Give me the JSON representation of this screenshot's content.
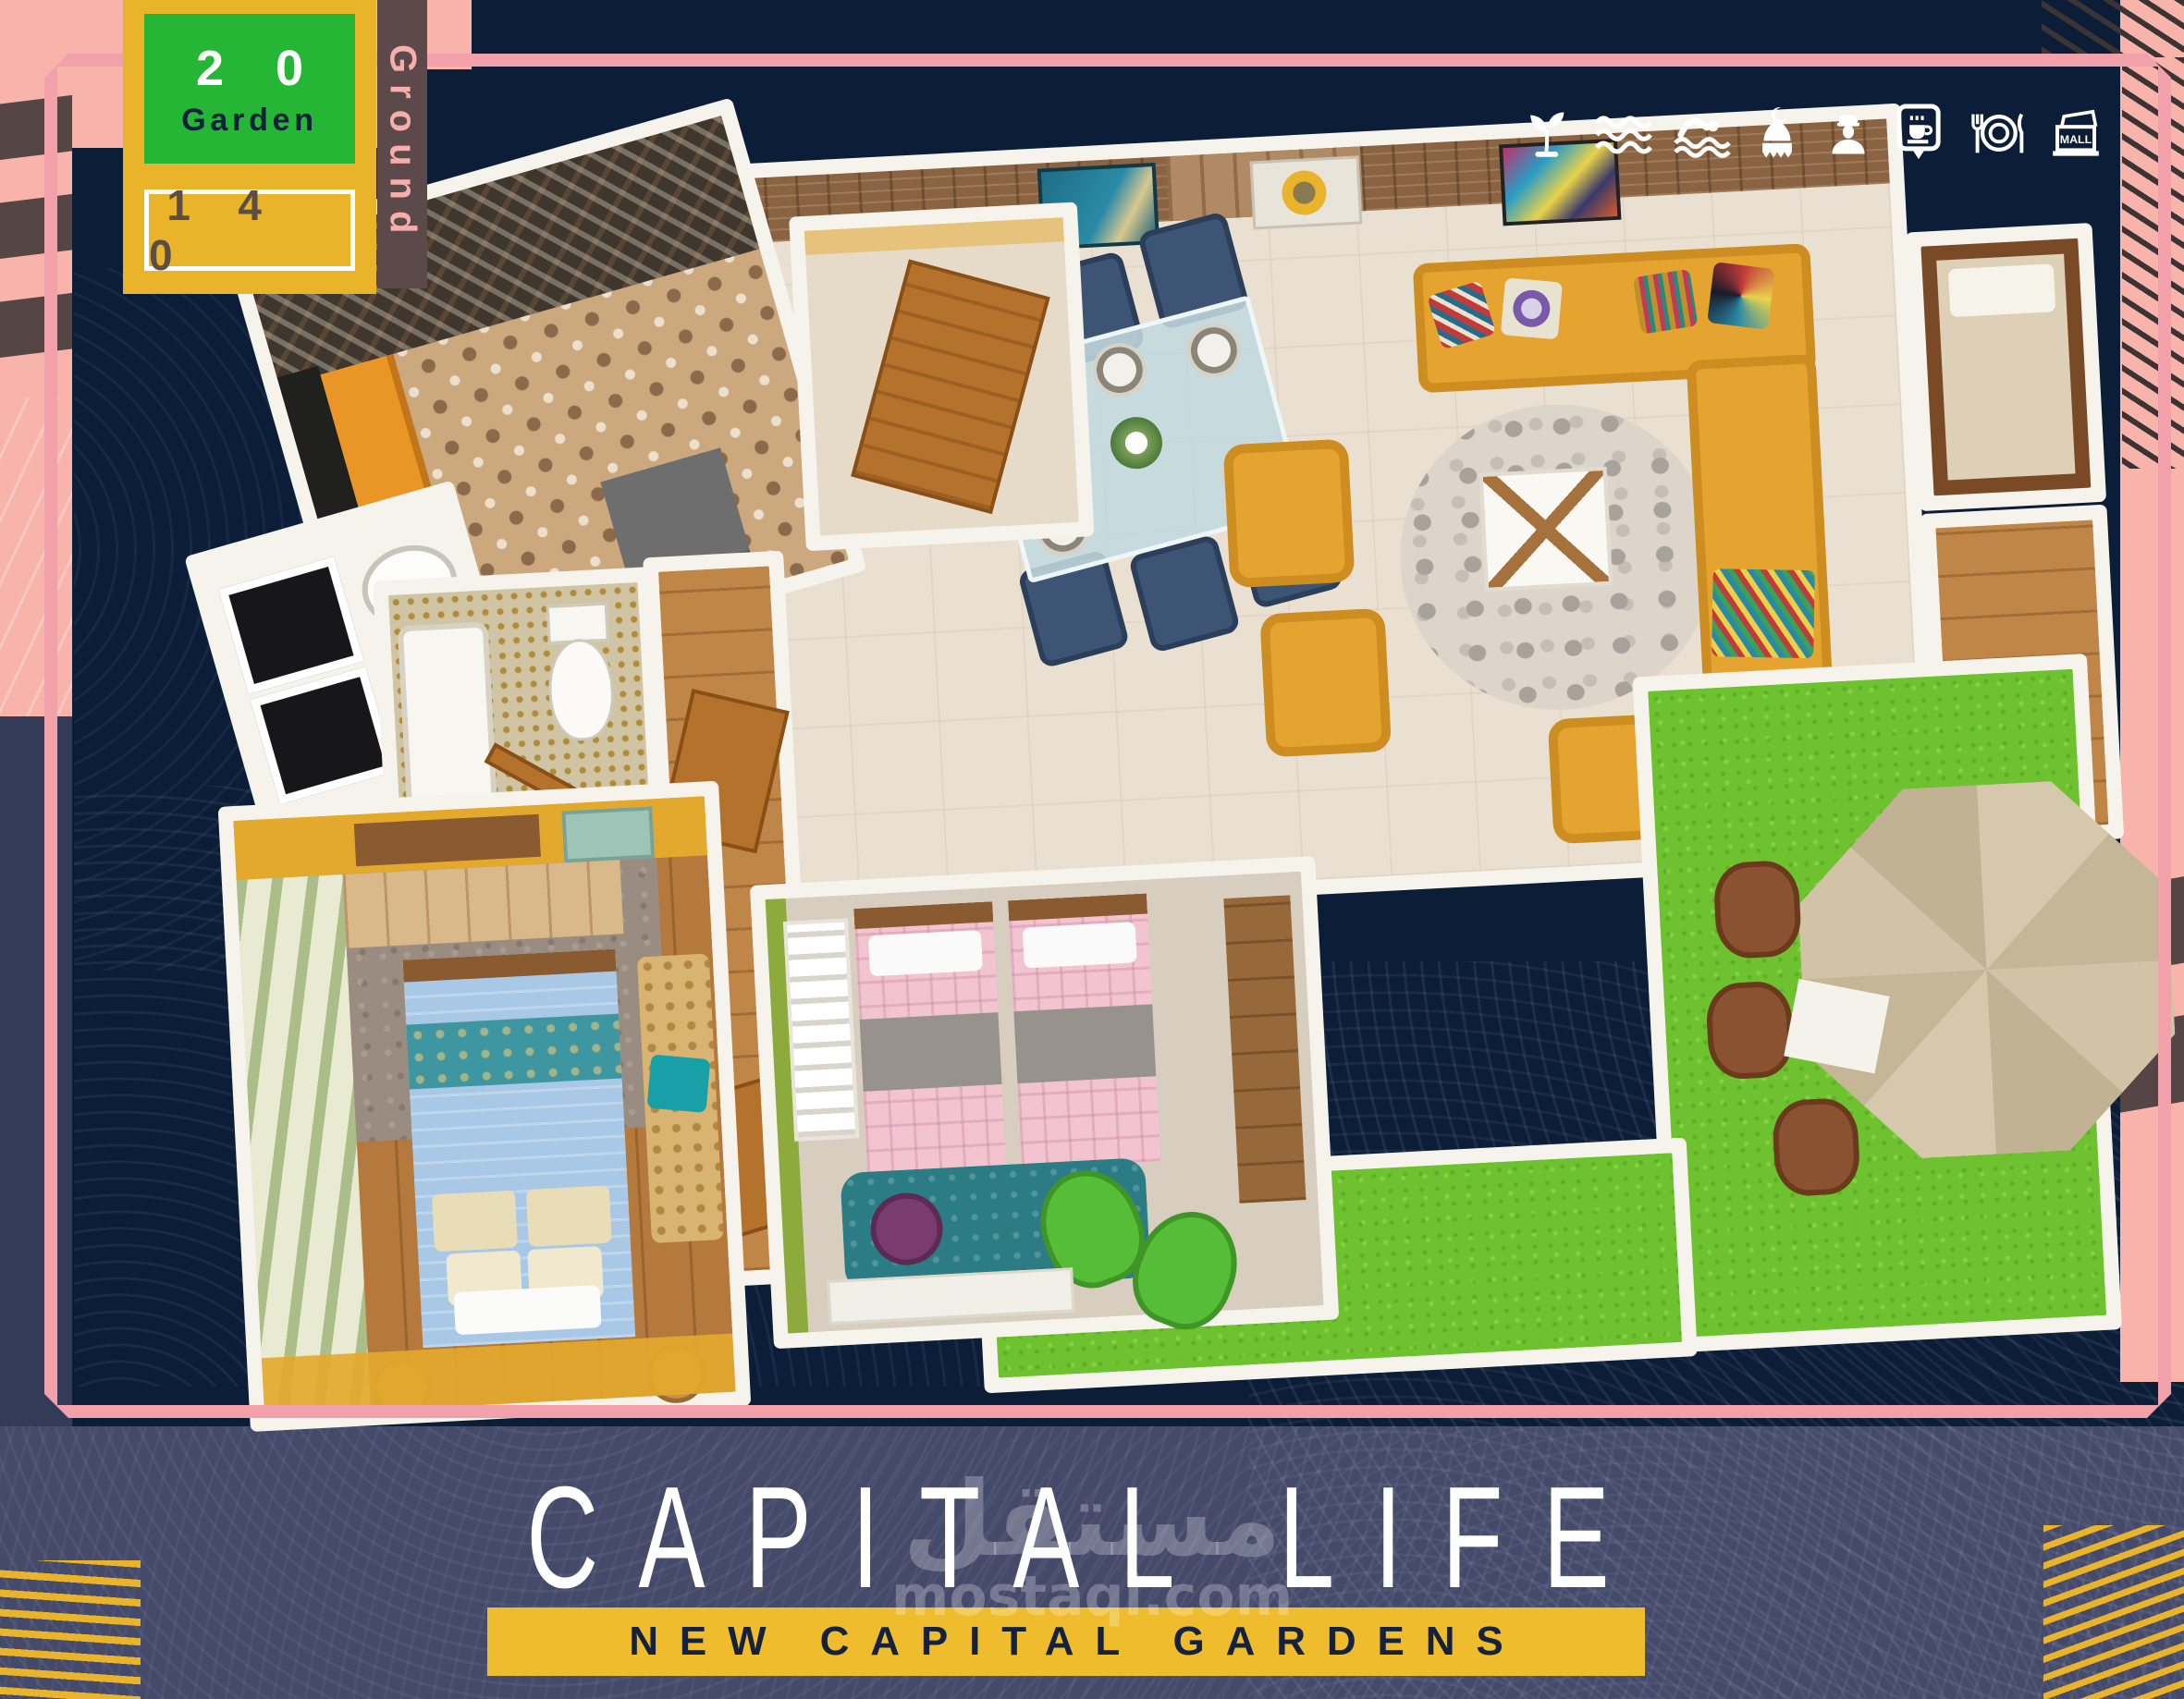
{
  "poster": {
    "badge": {
      "unit_number": "2 0",
      "unit_type": "Garden",
      "area": "1 4 0",
      "floor": "Ground"
    },
    "amenities": [
      {
        "name": "plant-icon"
      },
      {
        "name": "waves-icon"
      },
      {
        "name": "swimmer-icon"
      },
      {
        "name": "mosque-icon"
      },
      {
        "name": "security-guard-icon"
      },
      {
        "name": "cafe-sign-icon"
      },
      {
        "name": "restaurant-icon"
      },
      {
        "name": "mall-icon",
        "label": "MALL"
      }
    ],
    "footer": {
      "title": "CAPITAL LIFE",
      "subtitle": "NEW CAPITAL GARDENS"
    },
    "watermark": {
      "arabic": "مستقل",
      "domain": "mostaql.com"
    },
    "colors": {
      "background_navy": "#0c1d37",
      "panel_slate": "#454a6a",
      "pink_block": "#f8b3aa",
      "frame_pink": "#f2a0aa",
      "badge_yellow": "#e9b32a",
      "badge_green": "#25b636",
      "taupe_stripe": "#554544",
      "banner_yellow": "#eebc2c",
      "grass_green": "#6fc22f"
    }
  }
}
